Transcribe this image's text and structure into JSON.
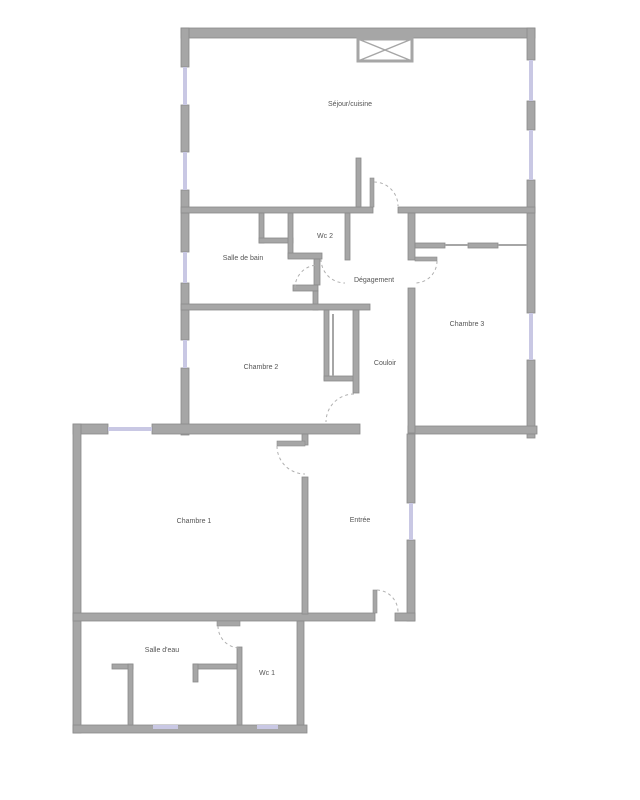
{
  "plan": {
    "title": "Apartment floor plan",
    "colors": {
      "wall": "#a6a6a6",
      "wall_outline": "#8a8a8a",
      "window": "#c9c8e4",
      "door_arc": "#b0b0b0",
      "label": "#555555",
      "background": "#ffffff"
    },
    "rooms": {
      "sejour": {
        "label": "Séjour/cuisine"
      },
      "wc2": {
        "label": "Wc 2"
      },
      "salle_de_bain": {
        "label": "Salle de bain"
      },
      "degagement": {
        "label": "Dégagement"
      },
      "chambre3": {
        "label": "Chambre 3"
      },
      "chambre2": {
        "label": "Chambre 2"
      },
      "couloir": {
        "label": "Couloir"
      },
      "chambre1": {
        "label": "Chambre 1"
      },
      "entree": {
        "label": "Entrée"
      },
      "salle_deau": {
        "label": "Salle d'eau"
      },
      "wc1": {
        "label": "Wc 1"
      }
    }
  }
}
